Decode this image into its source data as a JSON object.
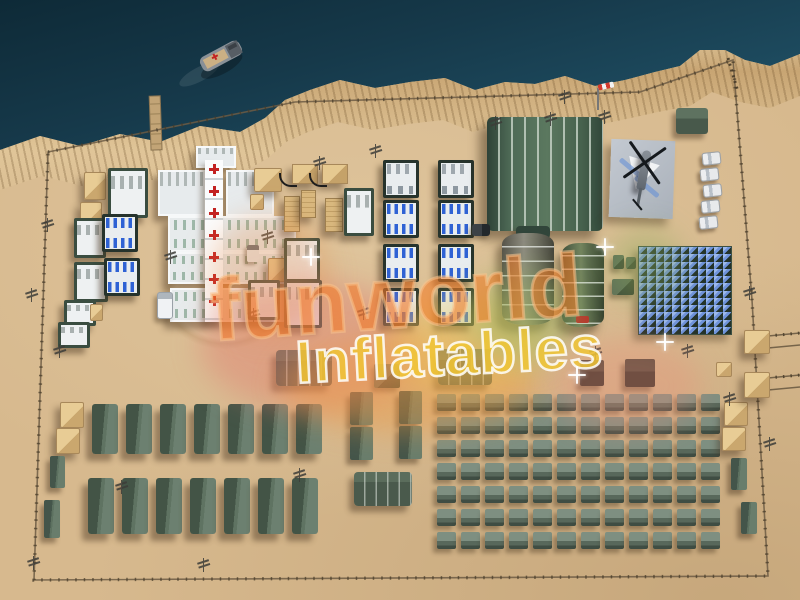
{
  "scene": {
    "title": "aerial 3d render of an inflatable military field camp on a desert seashore"
  },
  "watermark": {
    "line1": "funworld",
    "line2": "Inflatables",
    "brand_orange": "#f07429",
    "brand_yellow": "#eec23a"
  },
  "colors": {
    "water": "#1d4a5e",
    "sand": "#d7b98e",
    "dune": "#cfae7d",
    "tent_green": "#5a6f5e",
    "tent_dark": "#3f4f44",
    "hospital_white": "#eef1f2",
    "cross_red": "#c32222",
    "crate_tan": "#d9b87e",
    "solar_blue": "#6f93da",
    "helipad_grey": "#b8bec6",
    "hangar_green": "#5c6e55"
  },
  "camp": {
    "barracks_row1_count": 7,
    "barracks_row2_count": 7,
    "tent_grid": {
      "rows": 7,
      "cols": 12
    },
    "solar_array": {
      "rows": 12,
      "cols": 11
    },
    "hospital": {
      "wards": 3,
      "corridor_crosses": 7,
      "bed_tent_columns": 2,
      "bed_tent_rows": 4
    },
    "hangars": 2,
    "white_vehicle_positions": [
      [
        702,
        152
      ],
      [
        700,
        168
      ],
      [
        703,
        184
      ],
      [
        701,
        200
      ],
      [
        699,
        216
      ]
    ],
    "light_pole_positions": [
      [
        557,
        90
      ],
      [
        543,
        112
      ],
      [
        597,
        110
      ],
      [
        488,
        116
      ],
      [
        368,
        144
      ],
      [
        312,
        156
      ],
      [
        260,
        230
      ],
      [
        163,
        250
      ],
      [
        40,
        218
      ],
      [
        24,
        288
      ],
      [
        52,
        344
      ],
      [
        246,
        308
      ],
      [
        356,
        306
      ],
      [
        588,
        346
      ],
      [
        680,
        344
      ],
      [
        742,
        286
      ],
      [
        722,
        392
      ],
      [
        762,
        437
      ],
      [
        114,
        480
      ],
      [
        292,
        468
      ],
      [
        26,
        556
      ],
      [
        196,
        558
      ]
    ],
    "sparkle_positions": [
      [
        596,
        238
      ],
      [
        656,
        333
      ],
      [
        302,
        248
      ],
      [
        568,
        366
      ]
    ]
  }
}
